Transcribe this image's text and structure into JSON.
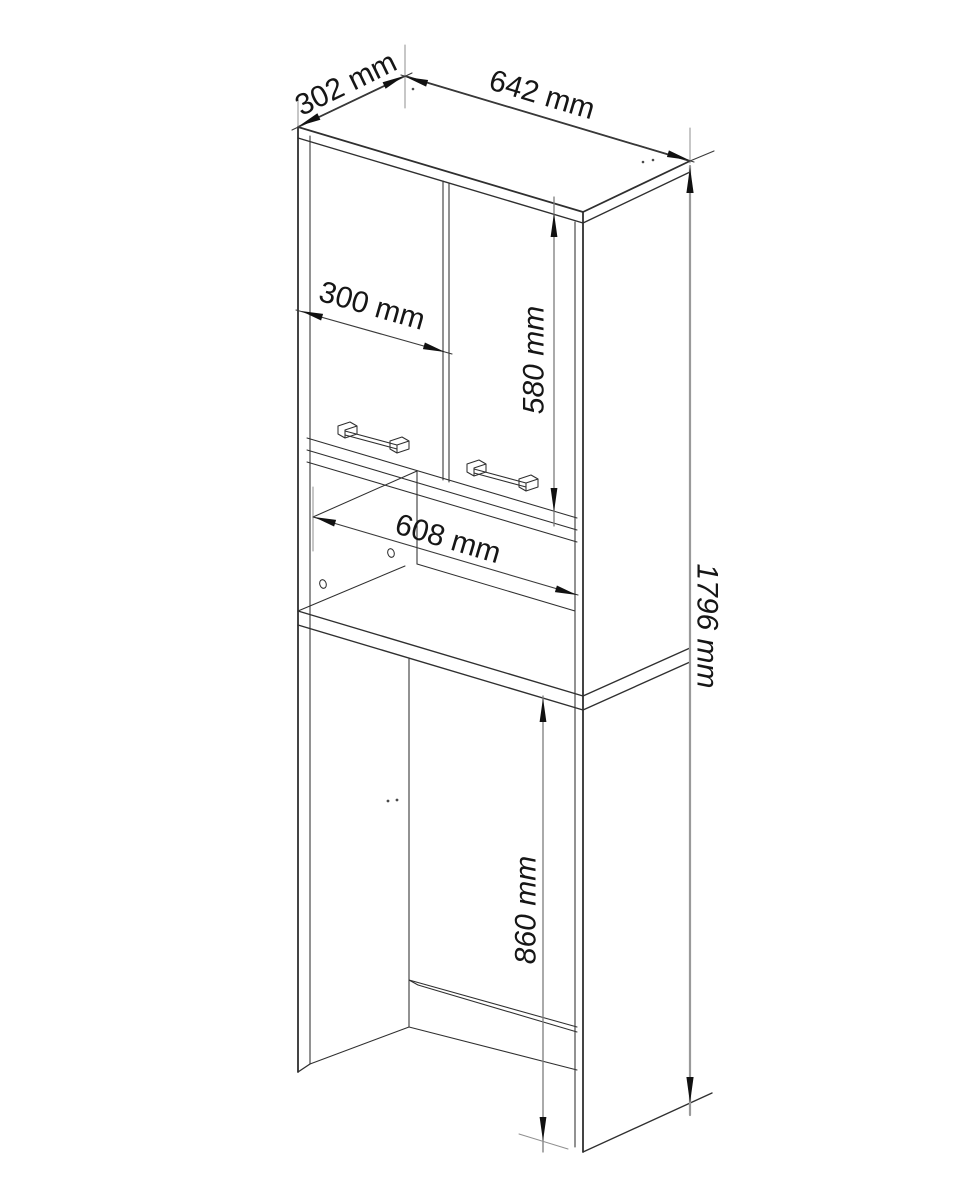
{
  "labels": {
    "top_depth": "302 mm",
    "top_width": "642 mm",
    "door_width": "300 mm",
    "upper_height": "580 mm",
    "inner_width": "608 mm",
    "total_height": "1796 mm",
    "niche_height": "860 mm"
  },
  "colors": {
    "outline": "#2f2f2f",
    "dimension_line": "#3a3a3a",
    "vertical_dimension_line": "#9a9a9a",
    "arrow": "#111111",
    "text": "#161616",
    "background": "#ffffff"
  }
}
